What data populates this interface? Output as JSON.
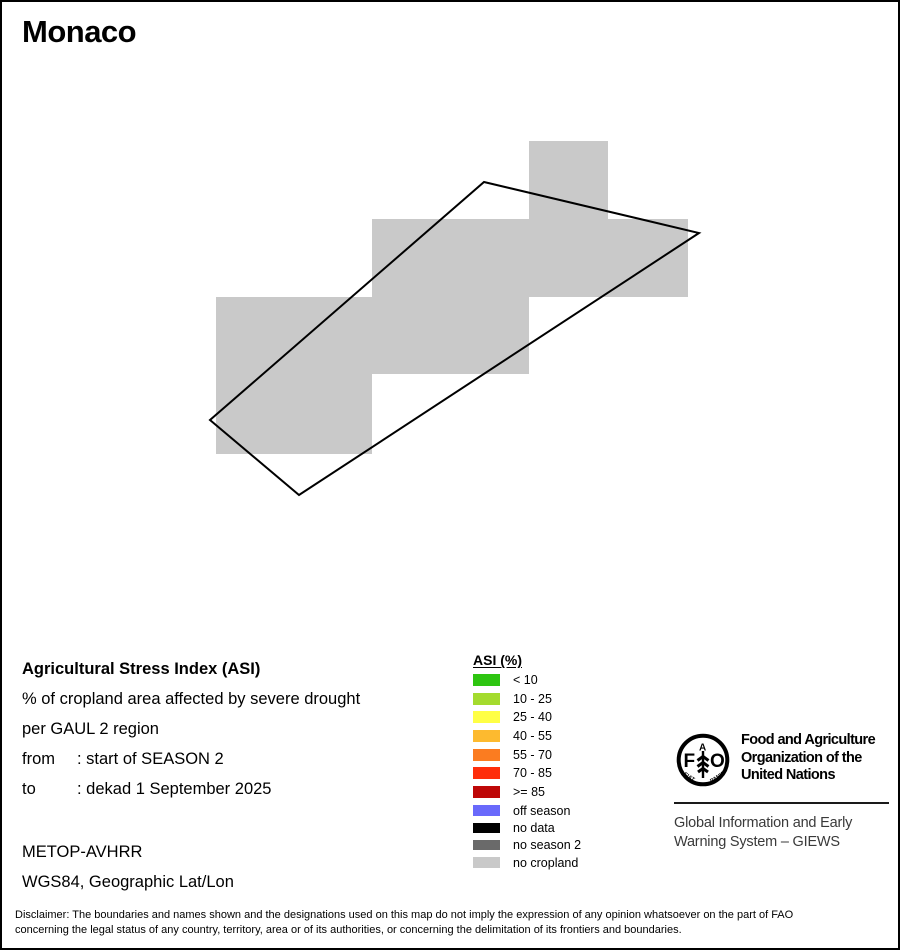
{
  "title": "Monaco",
  "map": {
    "no_cropland_color": "#C9C9C9",
    "outline_color": "#000000"
  },
  "info": {
    "heading": "Agricultural Stress Index (ASI)",
    "subtitle_line1": "% of cropland area affected by severe drought",
    "subtitle_line2": "per GAUL 2 region",
    "from_label": "from",
    "from_value": ": start of SEASON 2",
    "to_label": "to",
    "to_value": ": dekad 1 September 2025",
    "sensor": "METOP-AVHRR",
    "projection": "WGS84, Geographic Lat/Lon"
  },
  "legend": {
    "title": "ASI (%)",
    "classes": [
      {
        "label": "< 10",
        "color": "#2EC511"
      },
      {
        "label": "10 - 25",
        "color": "#A4DB2E"
      },
      {
        "label": "25 - 40",
        "color": "#FFFF45"
      },
      {
        "label": "40 - 55",
        "color": "#FDBA2F"
      },
      {
        "label": "55 - 70",
        "color": "#FB7C20"
      },
      {
        "label": "70 - 85",
        "color": "#FE2E0B"
      },
      {
        "label": ">= 85",
        "color": "#BE0707"
      }
    ],
    "statuses": [
      {
        "label": "off season",
        "color": "#6969FB"
      },
      {
        "label": "no data",
        "color": "#000000"
      },
      {
        "label": "no season 2",
        "color": "#6A6A6A"
      },
      {
        "label": "no cropland",
        "color": "#C9C9C9"
      }
    ]
  },
  "branding": {
    "org_line1": "Food and Agriculture",
    "org_line2": "Organization of the",
    "org_line3": "United Nations",
    "giews_line1": "Global Information and Early",
    "giews_line2": "Warning System – GIEWS",
    "logo": {
      "letter_f": "F",
      "letter_a": "A",
      "letter_o": "O",
      "motto_left": "FIAT",
      "motto_right": "PANIS"
    }
  },
  "disclaimer": {
    "line1": "Disclaimer: The boundaries and names shown and the designations used on this map do not imply the expression of any opinion whatsoever on the part of FAO",
    "line2": "concerning the legal status of any country, territory, area or of its authorities, or concerning the delimitation of its frontiers and boundaries."
  }
}
